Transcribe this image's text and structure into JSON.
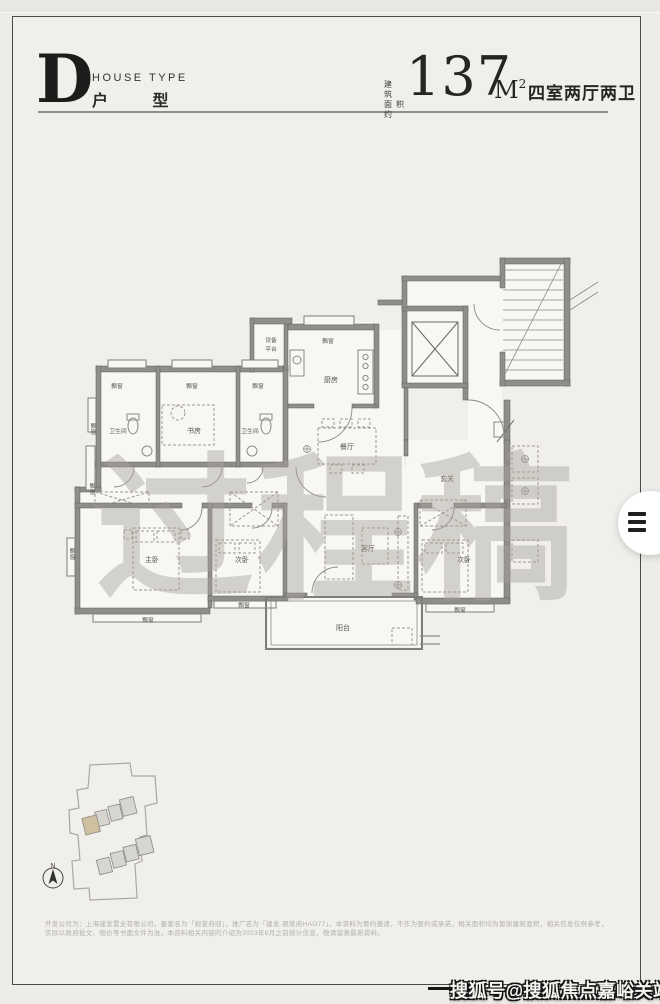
{
  "header": {
    "type_letter": "D",
    "type_label_en": "HOUSE TYPE",
    "type_label_cn": "户 型",
    "area_prefix_line1": "建 筑",
    "area_prefix_line2": "面积约",
    "area_value": "137",
    "area_unit": "M",
    "area_unit_sup": "2",
    "layout_spec": "四室两厅两卫"
  },
  "plan": {
    "draft_watermark": "过程稿",
    "rooms": {
      "bay_window": "飘窗",
      "equipment_line1": "设备",
      "equipment_line2": "平台",
      "kitchen": "厨房",
      "bathroom": "卫生间",
      "study": "书房",
      "dining": "餐厅",
      "foyer": "玄关",
      "master_bedroom": "主卧",
      "bedroom": "次卧",
      "living_room": "客厅",
      "balcony": "阳台"
    }
  },
  "site_plan": {
    "north": "N"
  },
  "footer": {
    "disclaimer_line1": "开发公司为：上海建发置业有限公司，备案名为「观棠府邸」，推广名为「建发·观棠府HAO77」。本资料为要约邀请，不作为要约或承诺，相关面积均为暂测建筑面积，相关信息仅供参考，",
    "disclaimer_line2": "实际以政府批文、物价等书面文件为准。本资料相关内容的介绍为2023年6月之前统计信息，敬请留意最新资料。"
  },
  "watermark": {
    "text": "搜狐号@搜狐焦点嘉峪关站"
  },
  "colors": {
    "page_bg": "#f1efeb",
    "wall": "#8f8e8b",
    "ink": "#262522",
    "highlight_building": "#cfc0a0"
  }
}
